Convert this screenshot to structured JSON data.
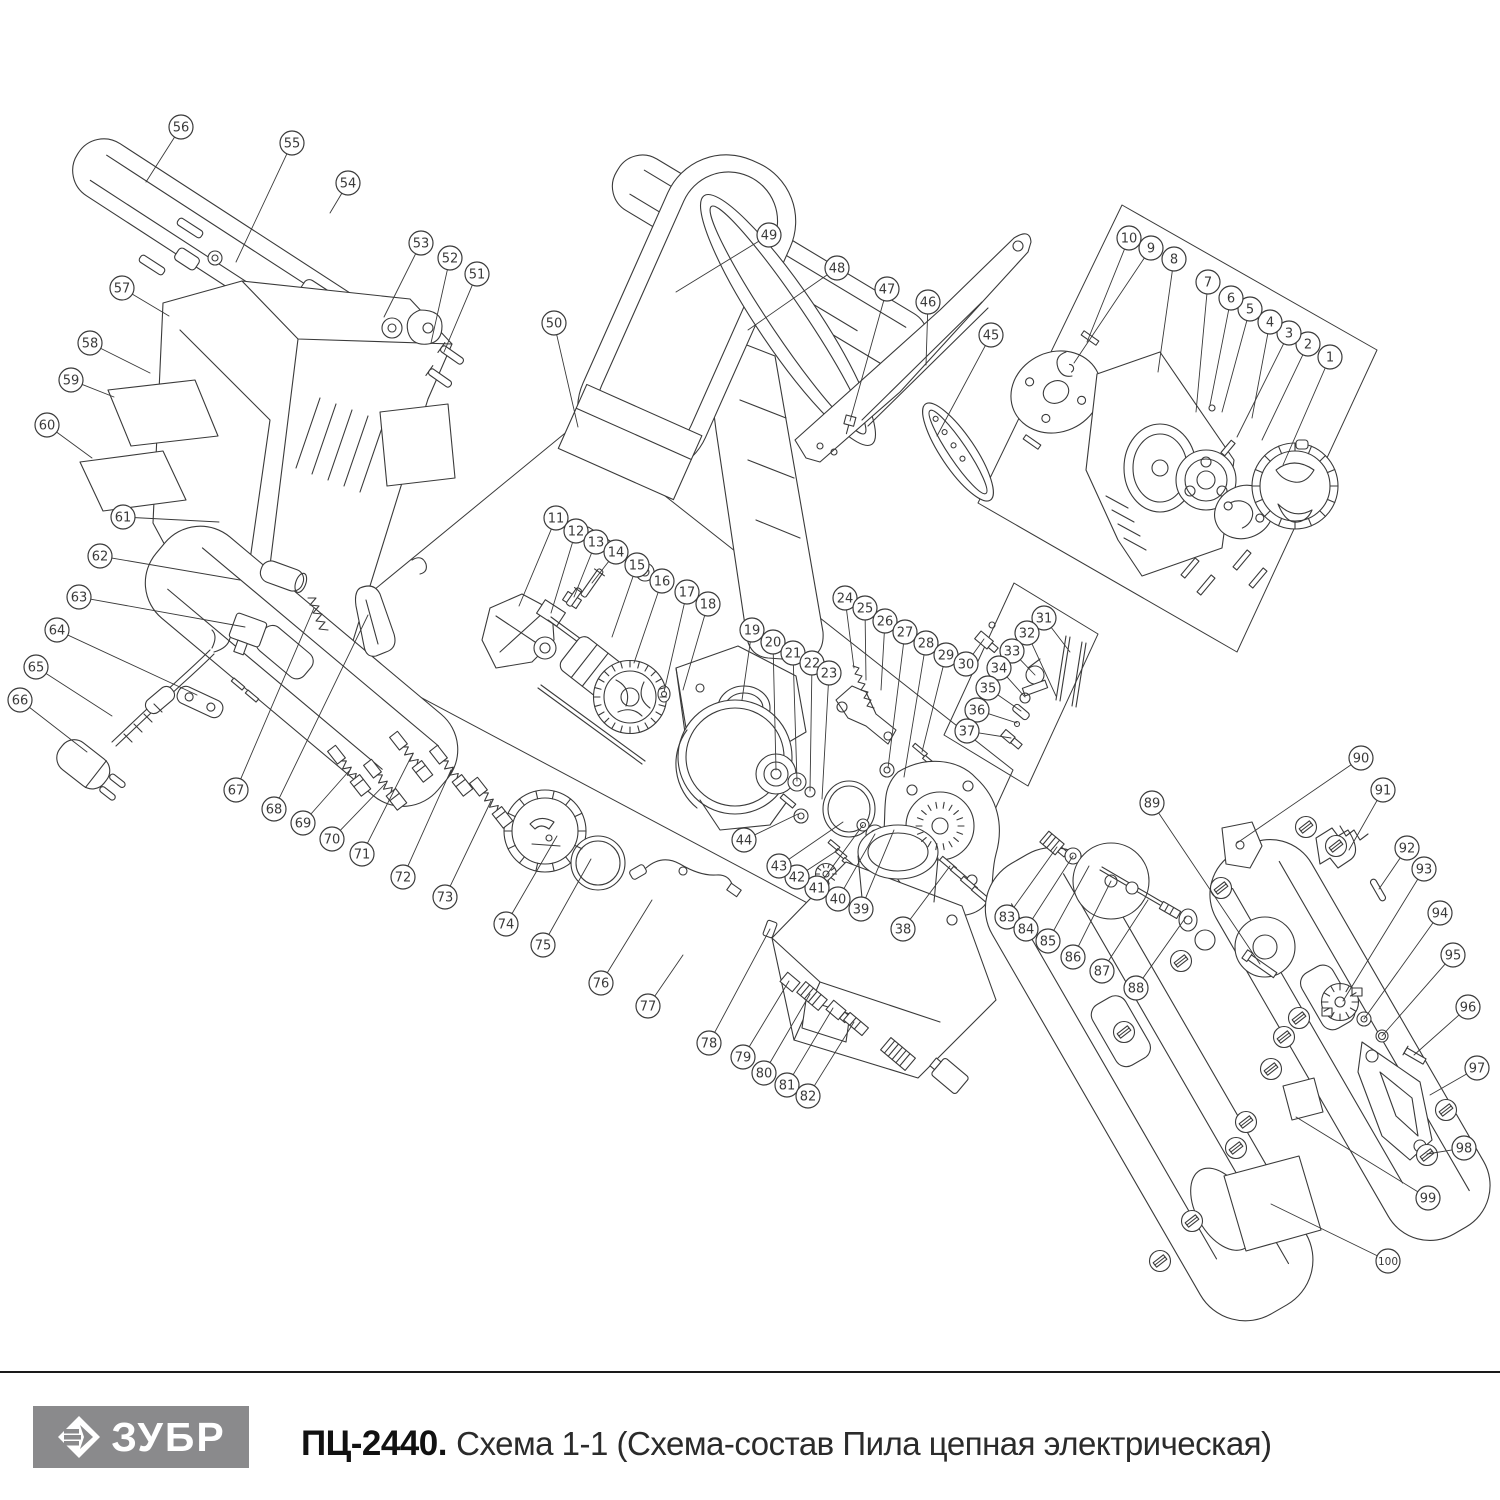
{
  "footer": {
    "divider_color": "#1a1a1a",
    "logo": {
      "text": "ЗУБР",
      "bg": "#8a8a8c",
      "fg": "#ffffff",
      "icon": "zubr-diamond-icon"
    },
    "model": "ПЦ-2440.",
    "subtitle": "Схема 1-1 (Схема-состав Пила цепная электрическая)"
  },
  "diagram": {
    "description": "Exploded-view spare parts schematic of an electric chain saw with numbered callouts 1-100",
    "ink": "#3a3a3a",
    "callout": {
      "radius": 12,
      "font_size": 13
    },
    "boxes": [
      "1122,205 1377,350 1237,652 978,503",
      "575,425 1013,770 924,965 313,640",
      "1014,583 1098,634 1028,786 944,735"
    ],
    "callouts": [
      {
        "n": 1,
        "cx": 1330,
        "cy": 357,
        "tx": 1283,
        "ty": 465
      },
      {
        "n": 2,
        "cx": 1308,
        "cy": 344,
        "tx": 1262,
        "ty": 440
      },
      {
        "n": 3,
        "cx": 1289,
        "cy": 333,
        "tx": 1237,
        "ty": 437
      },
      {
        "n": 4,
        "cx": 1270,
        "cy": 322,
        "tx": 1252,
        "ty": 418
      },
      {
        "n": 5,
        "cx": 1250,
        "cy": 309,
        "tx": 1222,
        "ty": 412
      },
      {
        "n": 6,
        "cx": 1231,
        "cy": 298,
        "tx": 1210,
        "ty": 405
      },
      {
        "n": 7,
        "cx": 1208,
        "cy": 282,
        "tx": 1196,
        "ty": 412
      },
      {
        "n": 8,
        "cx": 1174,
        "cy": 259,
        "tx": 1158,
        "ty": 372
      },
      {
        "n": 9,
        "cx": 1151,
        "cy": 248,
        "tx": 1074,
        "ty": 363
      },
      {
        "n": 10,
        "cx": 1129,
        "cy": 238,
        "tx": 1087,
        "ty": 342
      },
      {
        "n": 11,
        "cx": 556,
        "cy": 518,
        "tx": 519,
        "ty": 606
      },
      {
        "n": 12,
        "cx": 576,
        "cy": 531,
        "tx": 551,
        "ty": 613
      },
      {
        "n": 13,
        "cx": 596,
        "cy": 542,
        "tx": 574,
        "ty": 597
      },
      {
        "n": 14,
        "cx": 616,
        "cy": 552,
        "tx": 592,
        "ty": 583
      },
      {
        "n": 15,
        "cx": 637,
        "cy": 565,
        "tx": 612,
        "ty": 637
      },
      {
        "n": 16,
        "cx": 662,
        "cy": 581,
        "tx": 634,
        "ty": 663
      },
      {
        "n": 17,
        "cx": 687,
        "cy": 592,
        "tx": 664,
        "ty": 692
      },
      {
        "n": 18,
        "cx": 708,
        "cy": 604,
        "tx": 683,
        "ty": 690
      },
      {
        "n": 19,
        "cx": 752,
        "cy": 630,
        "tx": 742,
        "ty": 700
      },
      {
        "n": 20,
        "cx": 773,
        "cy": 642,
        "tx": 776,
        "ty": 770
      },
      {
        "n": 21,
        "cx": 793,
        "cy": 653,
        "tx": 797,
        "ty": 781
      },
      {
        "n": 22,
        "cx": 812,
        "cy": 663,
        "tx": 810,
        "ty": 791
      },
      {
        "n": 23,
        "cx": 829,
        "cy": 673,
        "tx": 822,
        "ty": 799
      },
      {
        "n": 24,
        "cx": 845,
        "cy": 598,
        "tx": 854,
        "ty": 668
      },
      {
        "n": 25,
        "cx": 865,
        "cy": 608,
        "tx": 866,
        "ty": 680
      },
      {
        "n": 26,
        "cx": 885,
        "cy": 621,
        "tx": 881,
        "ty": 690
      },
      {
        "n": 27,
        "cx": 905,
        "cy": 632,
        "tx": 888,
        "ty": 768
      },
      {
        "n": 28,
        "cx": 926,
        "cy": 643,
        "tx": 904,
        "ty": 777
      },
      {
        "n": 29,
        "cx": 946,
        "cy": 655,
        "tx": 922,
        "ty": 752
      },
      {
        "n": 30,
        "cx": 966,
        "cy": 664,
        "tx": 984,
        "ty": 639
      },
      {
        "n": 31,
        "cx": 1044,
        "cy": 618,
        "tx": 1070,
        "ty": 652
      },
      {
        "n": 32,
        "cx": 1027,
        "cy": 633,
        "tx": 1056,
        "ty": 696
      },
      {
        "n": 33,
        "cx": 1012,
        "cy": 651,
        "tx": 1035,
        "ty": 675
      },
      {
        "n": 34,
        "cx": 999,
        "cy": 668,
        "tx": 1025,
        "ty": 697
      },
      {
        "n": 35,
        "cx": 988,
        "cy": 688,
        "tx": 1021,
        "ty": 711
      },
      {
        "n": 36,
        "cx": 977,
        "cy": 710,
        "tx": 1017,
        "ty": 723
      },
      {
        "n": 37,
        "cx": 967,
        "cy": 731,
        "tx": 1011,
        "ty": 738
      },
      {
        "n": 38,
        "cx": 903,
        "cy": 929,
        "tx": 950,
        "ty": 866
      },
      {
        "n": 39,
        "cx": 861,
        "cy": 909,
        "tx": 894,
        "ty": 830
      },
      {
        "n": 40,
        "cx": 838,
        "cy": 899,
        "tx": 875,
        "ty": 834
      },
      {
        "n": 41,
        "cx": 817,
        "cy": 888,
        "tx": 863,
        "ty": 825
      },
      {
        "n": 42,
        "cx": 797,
        "cy": 877,
        "tx": 838,
        "ty": 850
      },
      {
        "n": 43,
        "cx": 779,
        "cy": 866,
        "tx": 843,
        "ty": 822
      },
      {
        "n": 44,
        "cx": 744,
        "cy": 840,
        "tx": 798,
        "ty": 814
      },
      {
        "n": 45,
        "cx": 991,
        "cy": 335,
        "tx": 937,
        "ty": 436
      },
      {
        "n": 46,
        "cx": 928,
        "cy": 302,
        "tx": 926,
        "ty": 365
      },
      {
        "n": 47,
        "cx": 887,
        "cy": 289,
        "tx": 850,
        "ty": 421
      },
      {
        "n": 48,
        "cx": 837,
        "cy": 268,
        "tx": 748,
        "ty": 330
      },
      {
        "n": 49,
        "cx": 769,
        "cy": 235,
        "tx": 676,
        "ty": 292
      },
      {
        "n": 50,
        "cx": 554,
        "cy": 323,
        "tx": 578,
        "ty": 427
      },
      {
        "n": 51,
        "cx": 477,
        "cy": 274,
        "tx": 444,
        "ty": 352
      },
      {
        "n": 52,
        "cx": 450,
        "cy": 258,
        "tx": 431,
        "ty": 343
      },
      {
        "n": 53,
        "cx": 421,
        "cy": 243,
        "tx": 384,
        "ty": 317
      },
      {
        "n": 54,
        "cx": 348,
        "cy": 183,
        "tx": 330,
        "ty": 213
      },
      {
        "n": 55,
        "cx": 292,
        "cy": 143,
        "tx": 236,
        "ty": 262
      },
      {
        "n": 56,
        "cx": 181,
        "cy": 127,
        "tx": 146,
        "ty": 182
      },
      {
        "n": 57,
        "cx": 122,
        "cy": 288,
        "tx": 169,
        "ty": 316
      },
      {
        "n": 58,
        "cx": 90,
        "cy": 343,
        "tx": 150,
        "ty": 373
      },
      {
        "n": 59,
        "cx": 71,
        "cy": 380,
        "tx": 114,
        "ty": 397
      },
      {
        "n": 60,
        "cx": 47,
        "cy": 425,
        "tx": 92,
        "ty": 458
      },
      {
        "n": 61,
        "cx": 123,
        "cy": 517,
        "tx": 219,
        "ty": 522
      },
      {
        "n": 62,
        "cx": 100,
        "cy": 556,
        "tx": 240,
        "ty": 580
      },
      {
        "n": 63,
        "cx": 79,
        "cy": 597,
        "tx": 245,
        "ty": 627
      },
      {
        "n": 64,
        "cx": 57,
        "cy": 630,
        "tx": 197,
        "ty": 695
      },
      {
        "n": 65,
        "cx": 36,
        "cy": 667,
        "tx": 112,
        "ty": 716
      },
      {
        "n": 66,
        "cx": 20,
        "cy": 700,
        "tx": 87,
        "ty": 752
      },
      {
        "n": 67,
        "cx": 236,
        "cy": 790,
        "tx": 314,
        "ty": 608
      },
      {
        "n": 68,
        "cx": 274,
        "cy": 809,
        "tx": 368,
        "ty": 615
      },
      {
        "n": 69,
        "cx": 303,
        "cy": 823,
        "tx": 349,
        "ty": 771
      },
      {
        "n": 70,
        "cx": 332,
        "cy": 839,
        "tx": 385,
        "ty": 784
      },
      {
        "n": 71,
        "cx": 362,
        "cy": 854,
        "tx": 411,
        "ty": 757
      },
      {
        "n": 72,
        "cx": 403,
        "cy": 877,
        "tx": 451,
        "ty": 770
      },
      {
        "n": 73,
        "cx": 445,
        "cy": 897,
        "tx": 491,
        "ty": 801
      },
      {
        "n": 74,
        "cx": 506,
        "cy": 924,
        "tx": 557,
        "ty": 836
      },
      {
        "n": 75,
        "cx": 543,
        "cy": 945,
        "tx": 591,
        "ty": 859
      },
      {
        "n": 76,
        "cx": 601,
        "cy": 983,
        "tx": 652,
        "ty": 900
      },
      {
        "n": 77,
        "cx": 648,
        "cy": 1006,
        "tx": 683,
        "ty": 955
      },
      {
        "n": 78,
        "cx": 709,
        "cy": 1043,
        "tx": 770,
        "ty": 929
      },
      {
        "n": 79,
        "cx": 743,
        "cy": 1057,
        "tx": 789,
        "ty": 981
      },
      {
        "n": 80,
        "cx": 764,
        "cy": 1073,
        "tx": 810,
        "ty": 994
      },
      {
        "n": 81,
        "cx": 787,
        "cy": 1085,
        "tx": 833,
        "ty": 1008
      },
      {
        "n": 82,
        "cx": 808,
        "cy": 1096,
        "tx": 854,
        "ty": 1022
      },
      {
        "n": 83,
        "cx": 1007,
        "cy": 917,
        "tx": 1057,
        "ty": 847
      },
      {
        "n": 84,
        "cx": 1026,
        "cy": 929,
        "tx": 1073,
        "ty": 856
      },
      {
        "n": 85,
        "cx": 1048,
        "cy": 941,
        "tx": 1089,
        "ty": 866
      },
      {
        "n": 86,
        "cx": 1073,
        "cy": 957,
        "tx": 1111,
        "ty": 881
      },
      {
        "n": 87,
        "cx": 1102,
        "cy": 971,
        "tx": 1148,
        "ty": 900
      },
      {
        "n": 88,
        "cx": 1136,
        "cy": 988,
        "tx": 1186,
        "ty": 917
      },
      {
        "n": 89,
        "cx": 1152,
        "cy": 803,
        "tx": 1260,
        "ty": 964
      },
      {
        "n": 90,
        "cx": 1361,
        "cy": 758,
        "tx": 1237,
        "ty": 843
      },
      {
        "n": 91,
        "cx": 1383,
        "cy": 790,
        "tx": 1349,
        "ty": 850
      },
      {
        "n": 92,
        "cx": 1407,
        "cy": 848,
        "tx": 1379,
        "ty": 889
      },
      {
        "n": 93,
        "cx": 1424,
        "cy": 869,
        "tx": 1343,
        "ty": 1001
      },
      {
        "n": 94,
        "cx": 1440,
        "cy": 913,
        "tx": 1364,
        "ty": 1019
      },
      {
        "n": 95,
        "cx": 1453,
        "cy": 955,
        "tx": 1382,
        "ty": 1036
      },
      {
        "n": 96,
        "cx": 1468,
        "cy": 1007,
        "tx": 1414,
        "ty": 1055
      },
      {
        "n": 97,
        "cx": 1477,
        "cy": 1068,
        "tx": 1430,
        "ty": 1095
      },
      {
        "n": 98,
        "cx": 1464,
        "cy": 1148,
        "tx": 1427,
        "ty": 1154
      },
      {
        "n": 99,
        "cx": 1428,
        "cy": 1198,
        "tx": 1296,
        "ty": 1117
      },
      {
        "n": 100,
        "cx": 1388,
        "cy": 1261,
        "tx": 1271,
        "ty": 1204
      }
    ],
    "screws": [
      [
        1306,
        827
      ],
      [
        1336,
        846
      ],
      [
        1221,
        888
      ],
      [
        1181,
        961
      ],
      [
        1299,
        1018
      ],
      [
        1284,
        1037
      ],
      [
        1271,
        1069
      ],
      [
        1246,
        1122
      ],
      [
        1124,
        1032
      ],
      [
        1236,
        1148
      ],
      [
        1192,
        1221
      ],
      [
        1160,
        1261
      ],
      [
        1446,
        1110
      ],
      [
        1427,
        1155
      ]
    ],
    "knurls": [
      {
        "cx": 1295,
        "cy": 486,
        "r1": 35,
        "r2": 43,
        "n": 16
      },
      {
        "cx": 545,
        "cy": 831,
        "r1": 33,
        "r2": 41,
        "n": 14
      },
      {
        "cx": 630,
        "cy": 697,
        "r1": 30,
        "r2": 36.5,
        "n": 24
      },
      {
        "cx": 826,
        "cy": 874,
        "r1": 6.5,
        "r2": 10.5,
        "n": 10
      },
      {
        "cx": 940,
        "cy": 826,
        "r1": 18,
        "r2": 24,
        "n": 18
      },
      {
        "cx": 1340,
        "cy": 1002,
        "r1": 12,
        "r2": 18.5,
        "n": 12
      }
    ]
  }
}
